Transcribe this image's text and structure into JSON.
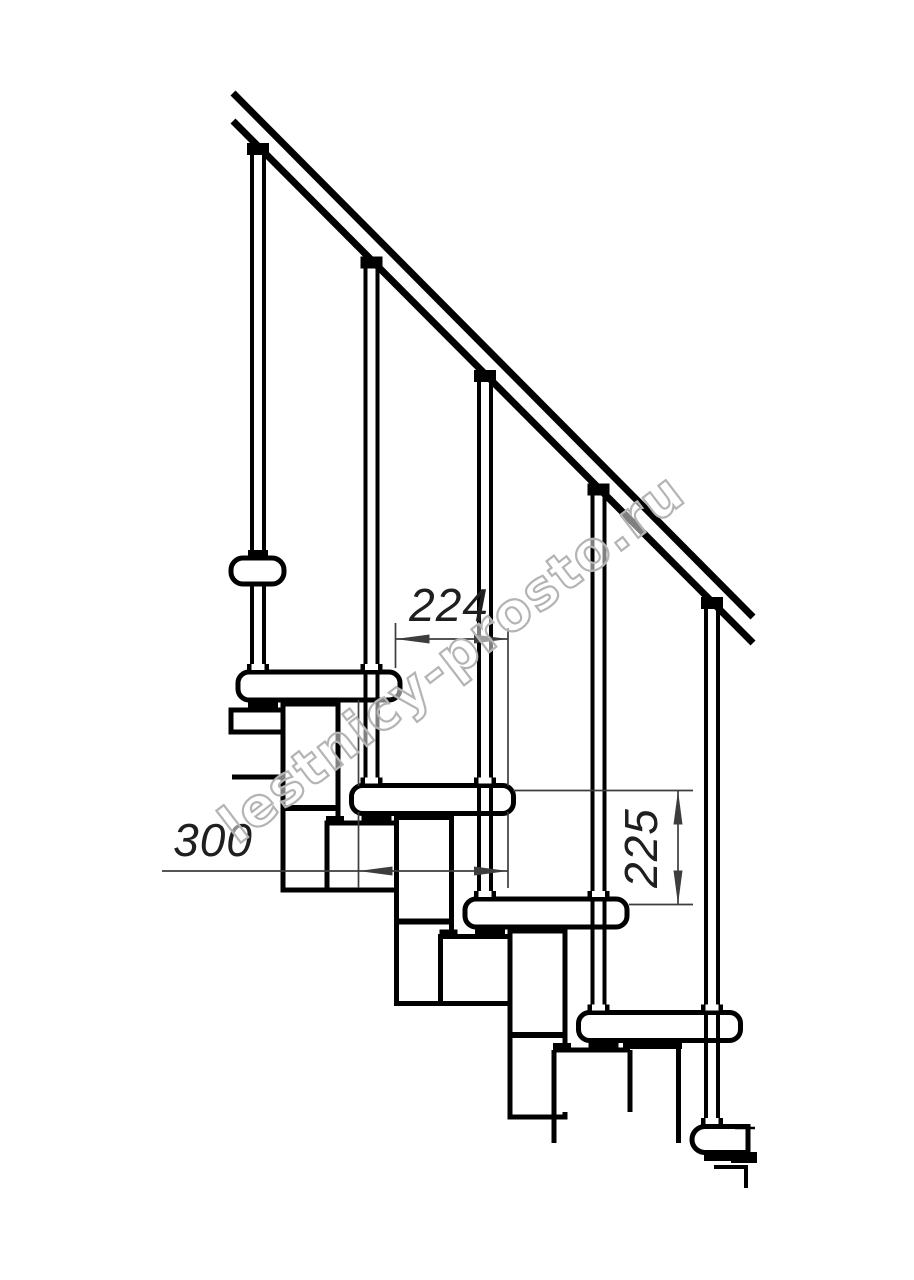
{
  "drawing": {
    "type": "technical side-view drawing of a modular staircase with handrail",
    "watermark": {
      "text": "lestnicy-prosto.ru"
    },
    "dimensions": {
      "step_run": "224",
      "tread_depth": "300",
      "riser_height": "225"
    },
    "colors": {
      "line": "#000000",
      "dim": "#3d3d3d",
      "dimtext": "#1f1f1f",
      "wmcolor": "#b4b4b4",
      "bg": "#ffffff"
    }
  }
}
